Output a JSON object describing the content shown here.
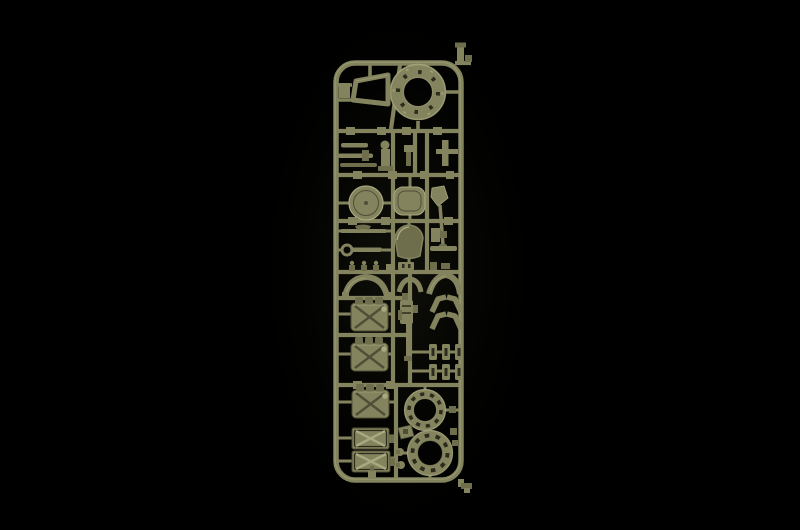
{
  "scene": {
    "description": "Photograph of an olive-green injection-moulded plastic model kit sprue (parts frame) lit against a black background",
    "parts": [
      "sprue-frame",
      "turret-ring",
      "gun-travel-lock-bracket",
      "axle-rods",
      "periscope",
      "small-mount",
      "t-bracket",
      "round-hatch",
      "oval-hatch",
      "shovel",
      "pickaxe",
      "wrench",
      "dome-cover",
      "small-clips",
      "fender-left",
      "fender-center",
      "fender-right",
      "jerry-can-1",
      "jerry-can-2",
      "jerry-can-3",
      "machine-gun",
      "angle-bracket-row-1",
      "angle-bracket-row-2",
      "suspension-block-grid",
      "idler-wheel-upper",
      "idler-wheel-lower",
      "jerry-can-panel-1",
      "jerry-can-panel-2",
      "small-fittings",
      "sprue-gate-tab-top",
      "sprue-gate-tab-bottom"
    ]
  },
  "colors": {
    "bg": "#000000",
    "glow": "#13130c",
    "base": "#83835e",
    "mid": "#6e6e4c",
    "highlight": "#a9a980",
    "shadow": "#4f4f37",
    "dark": "#2c2c1d",
    "hole": "#080806"
  }
}
